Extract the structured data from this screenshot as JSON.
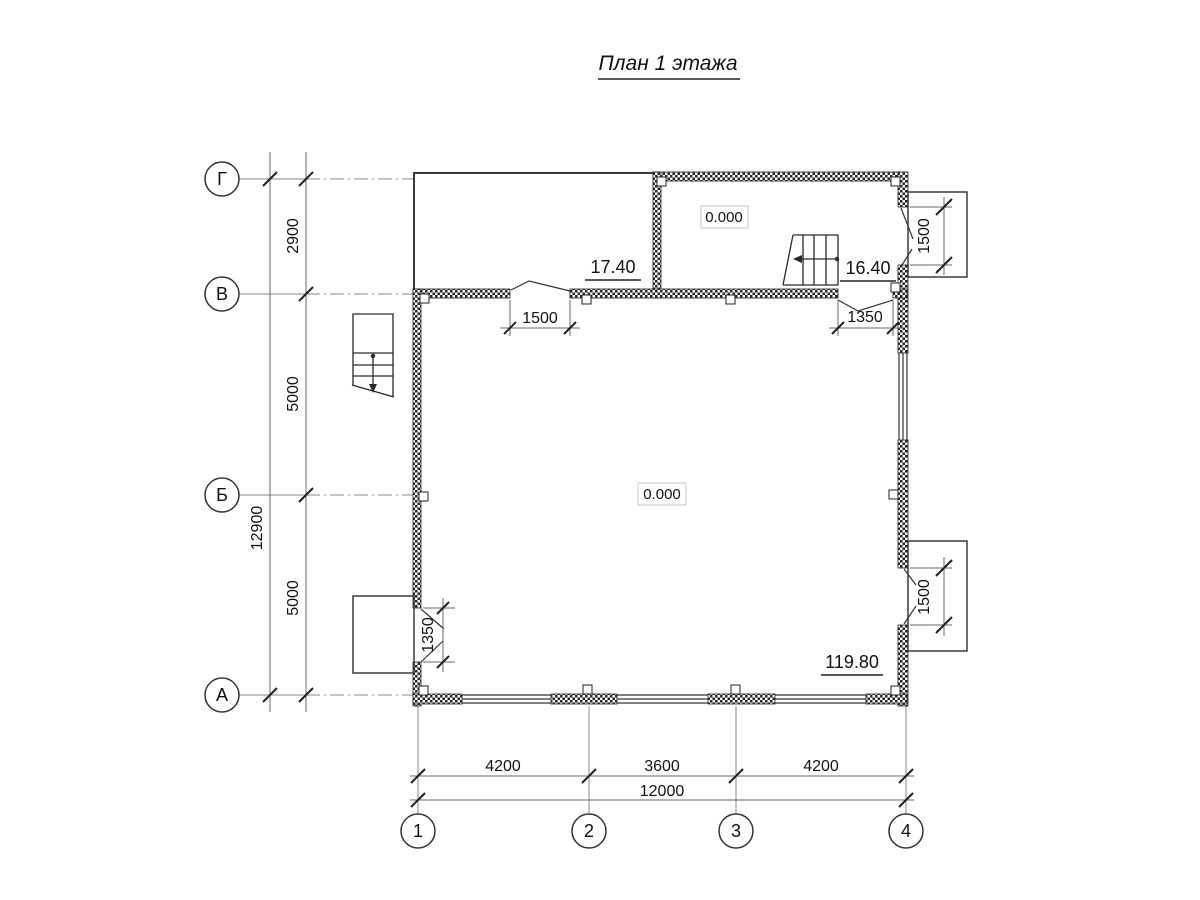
{
  "title": "План 1 этажа",
  "axis_rows": [
    {
      "label": "Г"
    },
    {
      "label": "В"
    },
    {
      "label": "Б"
    },
    {
      "label": "А"
    }
  ],
  "axis_cols": [
    {
      "label": "1"
    },
    {
      "label": "2"
    },
    {
      "label": "3"
    },
    {
      "label": "4"
    }
  ],
  "dims": {
    "row_spacing": [
      "2900",
      "5000",
      "5000"
    ],
    "row_total": "12900",
    "col_spacing": [
      "4200",
      "3600",
      "4200"
    ],
    "col_total": "12000",
    "door_b_left": "1500",
    "door_b_right": "1350",
    "door_left_wall": "1350",
    "porch_top_right": "1500",
    "porch_bottom_right": "1500"
  },
  "levels": {
    "main_room": "0.000",
    "stair_hall": "0.000"
  },
  "areas": {
    "terrace": "17.40",
    "stair_hall": "16.40",
    "main_room": "119.80"
  },
  "colors": {
    "line": "#2a2a2a",
    "dim_line": "#6a6a6a",
    "axis_line": "#8a8a8a",
    "level_box_border": "#c4c4c4"
  }
}
